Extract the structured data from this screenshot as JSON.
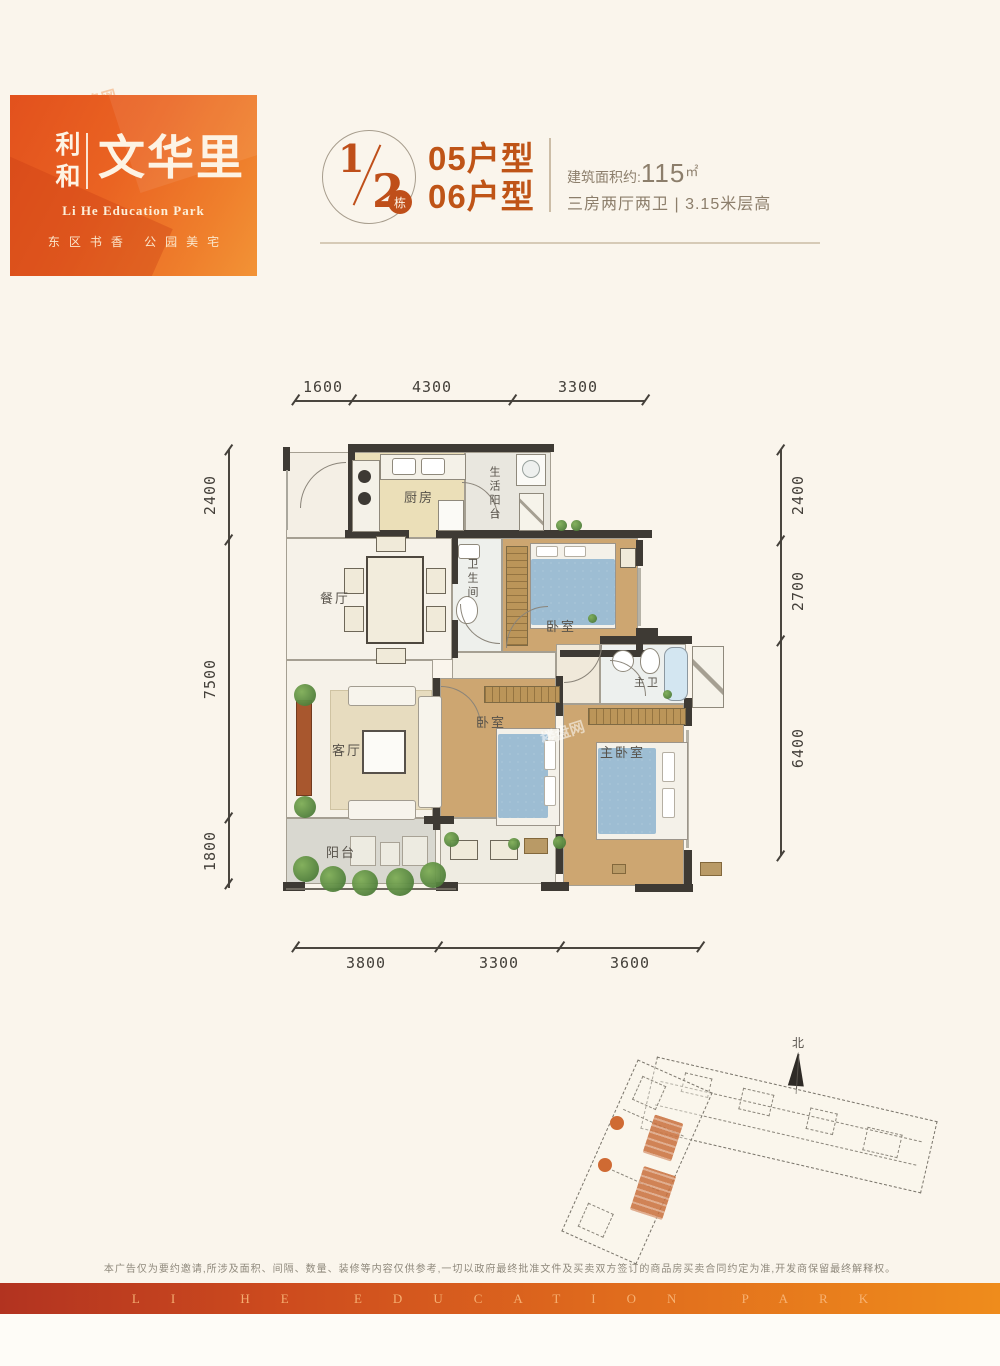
{
  "logo": {
    "brand": "利和",
    "name": "文华里",
    "subtitle": "Li He Education Park",
    "tagline": "东区书香 公园美宅",
    "bg_color": "#ea6322"
  },
  "header": {
    "numerator": "1",
    "denominator": "2",
    "badge": "栋",
    "unit1": "05户型",
    "unit2": "06户型",
    "area_label": "建筑面积约:",
    "area_value": "115",
    "area_unit": "㎡",
    "layout_spec": "三房两厅两卫",
    "spec_divider": "|",
    "height_spec": "3.15米层高",
    "accent_color": "#bf4f1a"
  },
  "floorplan": {
    "dims": {
      "top": [
        "1600",
        "4300",
        "3300"
      ],
      "left": [
        "2400",
        "7500",
        "1800"
      ],
      "right": [
        "2400",
        "2700",
        "6400"
      ],
      "bottom": [
        "3800",
        "3300",
        "3600"
      ]
    },
    "rooms": {
      "kitchen": "厨房",
      "utility": "生活阳台",
      "dining": "餐厅",
      "bath": "卫生间",
      "bedroom_a": "卧室",
      "master_bath": "主卫",
      "living": "客厅",
      "bedroom_b": "卧室",
      "master_bedroom": "主卧室",
      "balcony": "阳台"
    }
  },
  "siteplan": {
    "north": "北"
  },
  "watermark": "楼盘网",
  "footer": {
    "disclaimer": "本广告仅为要约邀请,所涉及面积、间隔、数量、装修等内容仅供参考,一切以政府最终批准文件及买卖双方签订的商品房买卖合同约定为准,开发商保留最终解释权。",
    "band": "LI HE EDUCATION PARK",
    "band_colors": [
      "#b23320",
      "#ef8c1c"
    ]
  }
}
